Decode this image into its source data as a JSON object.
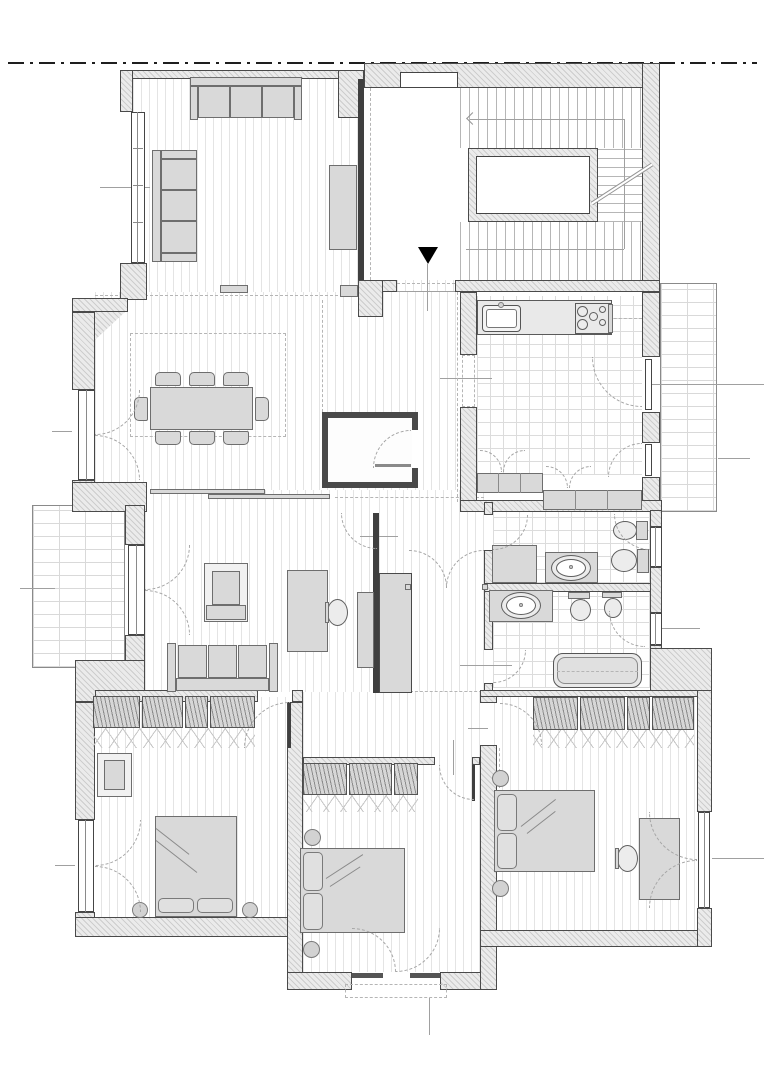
{
  "document": {
    "kind": "architectural floor plan",
    "visible_text": [],
    "entrance_marker": "solid black triangle pointing down at apartment entry",
    "property_line_style": "dash-dot horizontal line across top"
  },
  "colors": {
    "bg": "#ffffff",
    "wall-outline": "#4a4a4a",
    "furniture-fill": "#d9d9d9",
    "furniture-outline": "#6e6e6e",
    "marker": "#000000",
    "dash": "#b5b5b5",
    "ref": "#a0a0a0"
  },
  "plan": {
    "stair": {
      "type": "U-shaped stair around open well",
      "flights": 3,
      "direction_arrow": "left-pointing arrow on upper flight",
      "landing": "white entry landing"
    },
    "balconies": [
      "left balcony (brick paving)",
      "right balcony off kitchen (brick paving)",
      "rear juliet balcony off middle bedroom (dashed)"
    ],
    "rooms": [
      {
        "id": "living-room-upper",
        "floor": "wood strip",
        "furniture": [
          "three-seat sofa at top wall",
          "three-seat sofa at left wall",
          "tall cabinet at right wall",
          "radiators"
        ]
      },
      {
        "id": "dining-room",
        "floor": "wood strip",
        "furniture": [
          "dining table",
          "eight chairs",
          "dashed ceiling recess",
          "french door to left"
        ]
      },
      {
        "id": "kitchen",
        "floor": "tile",
        "furniture": [
          "counter with sink",
          "cooktop with burners",
          "base cabinets",
          "two french doors to right balcony"
        ]
      },
      {
        "id": "entry-hall",
        "floor": "wood strip",
        "furniture": [
          "walk-in closet",
          "bookcase",
          "double door"
        ]
      },
      {
        "id": "living-room-lower",
        "floor": "wood strip",
        "furniture": [
          "armchair",
          "desk with office chair",
          "three-seat sofa",
          "cabinet",
          "french door to left balcony",
          "sliding door to dining"
        ]
      },
      {
        "id": "bathroom-1",
        "floor": "tile",
        "furniture": [
          "cabinet",
          "washbasin counter",
          "bidet",
          "toilet",
          "inward-opening window"
        ]
      },
      {
        "id": "bathroom-2",
        "floor": "tile",
        "furniture": [
          "washbasin counter",
          "toilet",
          "bidet",
          "bathtub",
          "inward-opening window"
        ]
      },
      {
        "id": "bedroom-1",
        "floor": "wood strip",
        "furniture": [
          "four-section wardrobe",
          "armchair",
          "double bed with two pillows",
          "two round bedside tables",
          "french door to left"
        ]
      },
      {
        "id": "bedroom-2",
        "floor": "wood strip",
        "furniture": [
          "three-section wardrobe",
          "double bed with two pillows",
          "two round bedside tables",
          "french door to rear juliet balcony"
        ]
      },
      {
        "id": "bedroom-3",
        "floor": "wood strip",
        "furniture": [
          "four-section wardrobe",
          "double bed with two pillows",
          "two round bedside tables",
          "desk with office chair",
          "french window to right"
        ]
      }
    ]
  }
}
